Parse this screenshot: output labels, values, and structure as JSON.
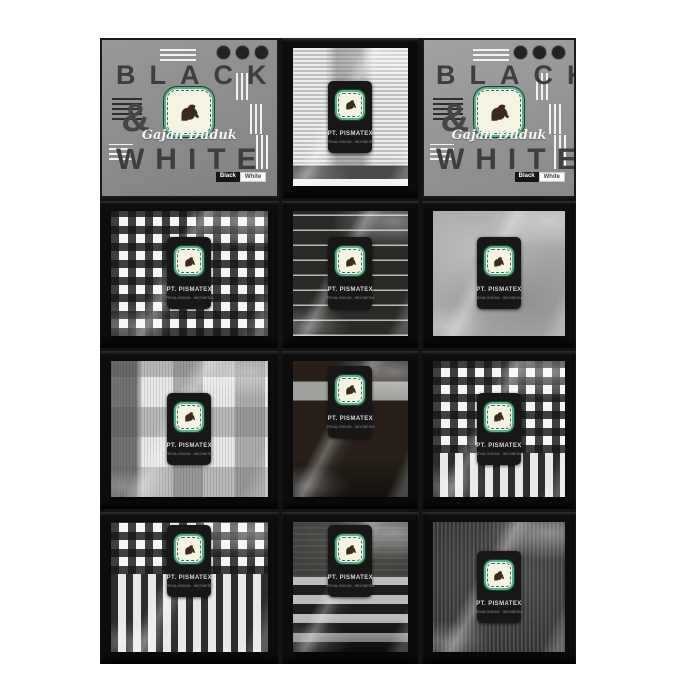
{
  "photo": {
    "type": "product-photograph",
    "subject": "Gajah Duduk 'Black & White' woven sarong gift boxes arranged in a 3x4 grid, each open box holds a folded fabric in clear plastic wrap with a black hang label",
    "background_color": "#ffffff",
    "box_color": "#0e0e0e",
    "lid_gray": "#919191",
    "logo_green": "#5cac8e"
  },
  "brand": {
    "black_text": "BLACK",
    "ampersand": "&",
    "white_text": "WHITE",
    "script_name": "Gajah Duduk",
    "badge_black": "Black",
    "badge_white": "White"
  },
  "pack_label": {
    "line1": "PT. PISMATEX",
    "line2": "PEKALONGAN - INDONESIA"
  },
  "grid": {
    "rows": 4,
    "cols": 3,
    "cells": [
      {
        "pos": "r1c1",
        "type": "box-lid",
        "pattern": "gray lid with BLACK & WHITE typography, elephant logo, stripe decorations"
      },
      {
        "pos": "r1c2",
        "type": "open-box",
        "pattern": "fine light horizontal stripes with dark band at hem"
      },
      {
        "pos": "r1c3",
        "type": "box-lid",
        "pattern": "gray lid with BLACK & WHITE typography, elephant logo, stripe decorations"
      },
      {
        "pos": "r2c1",
        "type": "open-box",
        "pattern": "black and white gingham check"
      },
      {
        "pos": "r2c2",
        "type": "open-box",
        "pattern": "charcoal with thin white horizontal pinstripes"
      },
      {
        "pos": "r2c3",
        "type": "open-box",
        "pattern": "plain light gray"
      },
      {
        "pos": "r3c1",
        "type": "open-box",
        "pattern": "light gray glen plaid blocks with fine ribs"
      },
      {
        "pos": "r3c2",
        "type": "open-box",
        "pattern": "dark brown with light gray horizontal band"
      },
      {
        "pos": "r3c3",
        "type": "open-box",
        "pattern": "gingham check with vertical stripe hem"
      },
      {
        "pos": "r4c1",
        "type": "open-box",
        "pattern": "gingham check top, bold vertical stripes bottom"
      },
      {
        "pos": "r4c2",
        "type": "open-box",
        "pattern": "dark gray top, bold black and gray horizontal stripes"
      },
      {
        "pos": "r4c3",
        "type": "open-box",
        "pattern": "charcoal fine vertical pinstripes"
      }
    ]
  }
}
